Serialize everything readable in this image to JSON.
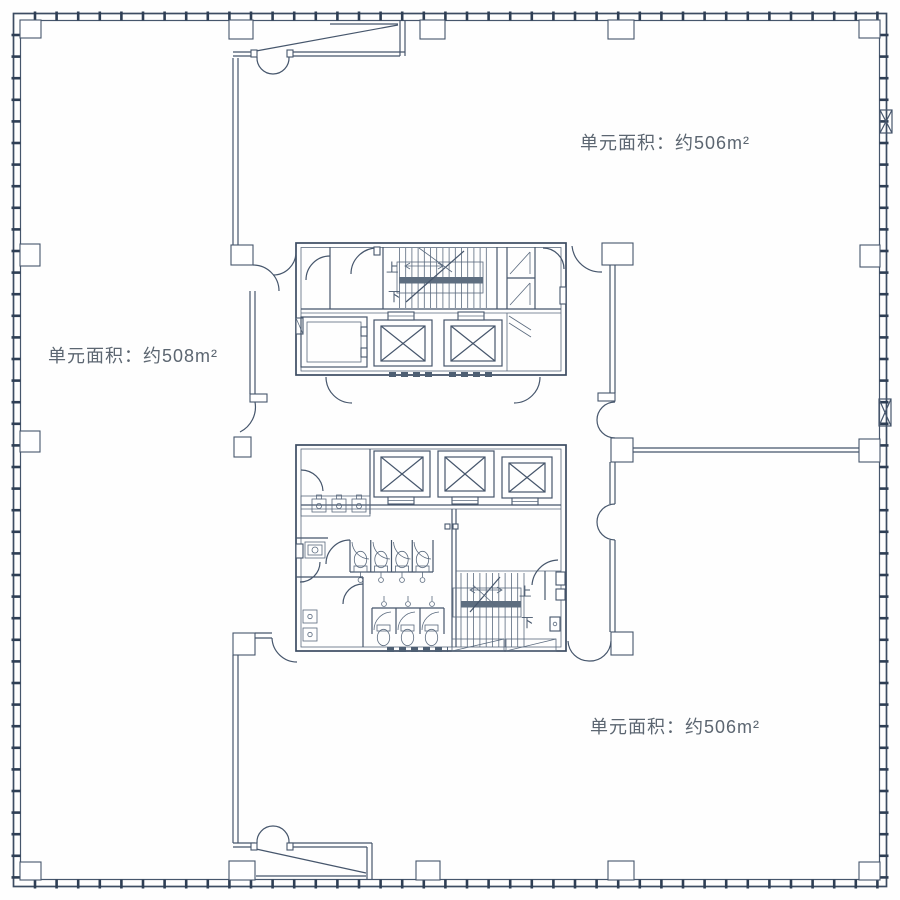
{
  "page": {
    "type": "architectural-floor-plan",
    "background": "#fefefe"
  },
  "colors": {
    "line": "#46566c",
    "line_dark": "#2e3e54",
    "stair_landing": "#5e6e80",
    "label_text": "#5c6671"
  },
  "units": [
    {
      "id": "unit-right-top",
      "label": "单元面积：约506m²"
    },
    {
      "id": "unit-left",
      "label": "单元面积：约508m²"
    },
    {
      "id": "unit-right-bottom",
      "label": "单元面积：约506m²"
    }
  ],
  "stairs": {
    "upper": {
      "up_label": "上",
      "down_label": "下"
    },
    "lower": {
      "up_label": "上",
      "down_label": "下"
    }
  }
}
